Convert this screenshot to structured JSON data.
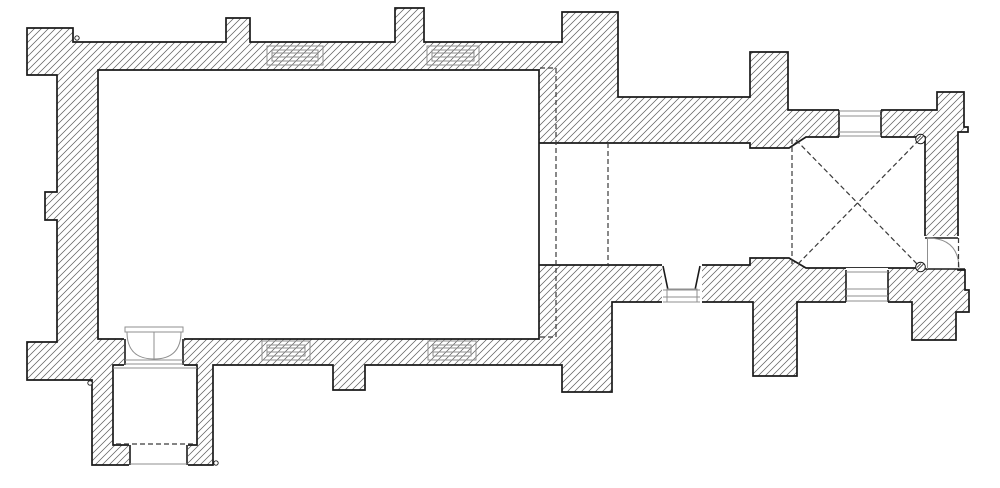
{
  "plan": {
    "name": "church-floor-plan",
    "canvas": {
      "width": 1000,
      "height": 488,
      "background": "#ffffff"
    },
    "style": {
      "outline_color": "#1a1a1a",
      "outline_width": 1.7,
      "hatch_color": "#5f5f5f",
      "hatch_width": 0.75,
      "hatch_spacing": 7,
      "detail_color": "#8f8f8f",
      "detail_width": 1,
      "black_detail_width": 1.6,
      "dash_color": "#3a3a3a",
      "dash_width": 1.2,
      "dash_pattern": "5,3"
    },
    "wall_outline": {
      "name": "exterior-wall-outline",
      "points": [
        [
          27,
          28
        ],
        [
          73,
          28
        ],
        [
          73,
          42
        ],
        [
          226,
          42
        ],
        [
          226,
          18
        ],
        [
          250,
          18
        ],
        [
          250,
          42
        ],
        [
          395,
          42
        ],
        [
          395,
          8
        ],
        [
          424,
          8
        ],
        [
          424,
          42
        ],
        [
          562,
          42
        ],
        [
          562,
          12
        ],
        [
          618,
          12
        ],
        [
          618,
          97
        ],
        [
          750,
          97
        ],
        [
          750,
          52
        ],
        [
          788,
          52
        ],
        [
          788,
          110
        ],
        [
          937,
          110
        ],
        [
          937,
          92
        ],
        [
          964,
          92
        ],
        [
          964,
          127
        ],
        [
          968,
          127
        ],
        [
          968,
          132
        ],
        [
          958,
          132
        ],
        [
          958,
          270
        ],
        [
          965,
          270
        ],
        [
          965,
          290
        ],
        [
          969,
          290
        ],
        [
          969,
          312
        ],
        [
          956,
          312
        ],
        [
          956,
          340
        ],
        [
          912,
          340
        ],
        [
          912,
          302
        ],
        [
          797,
          302
        ],
        [
          797,
          376
        ],
        [
          753,
          376
        ],
        [
          753,
          302
        ],
        [
          612,
          302
        ],
        [
          612,
          392
        ],
        [
          562,
          392
        ],
        [
          562,
          365
        ],
        [
          365,
          365
        ],
        [
          365,
          390
        ],
        [
          333,
          390
        ],
        [
          333,
          365
        ],
        [
          213,
          365
        ],
        [
          213,
          465
        ],
        [
          92,
          465
        ],
        [
          92,
          380
        ],
        [
          27,
          380
        ],
        [
          27,
          342
        ],
        [
          57,
          342
        ],
        [
          57,
          220
        ],
        [
          45,
          220
        ],
        [
          45,
          192
        ],
        [
          57,
          192
        ],
        [
          57,
          75
        ],
        [
          27,
          75
        ]
      ]
    },
    "room_openings": [
      {
        "name": "nave-interior",
        "points": [
          [
            98,
            70
          ],
          [
            539,
            70
          ],
          [
            539,
            339
          ],
          [
            98,
            339
          ]
        ]
      },
      {
        "name": "chancel-and-tower-interior",
        "points": [
          [
            539,
            143
          ],
          [
            750,
            143
          ],
          [
            750,
            148
          ],
          [
            789,
            148
          ],
          [
            806,
            137
          ],
          [
            925,
            137
          ],
          [
            925,
            268
          ],
          [
            806,
            268
          ],
          [
            789,
            258
          ],
          [
            750,
            258
          ],
          [
            750,
            265
          ],
          [
            539,
            265
          ]
        ]
      },
      {
        "name": "porch-interior",
        "points": [
          [
            113,
            365
          ],
          [
            197,
            365
          ],
          [
            197,
            445
          ],
          [
            113,
            445
          ]
        ]
      }
    ],
    "white_patches": [
      {
        "name": "tower-north-window-gap",
        "rect": [
          839,
          108,
          42,
          31
        ]
      },
      {
        "name": "tower-south-window-gap",
        "rect": [
          846,
          268,
          42,
          36
        ]
      },
      {
        "name": "chancel-south-window-gap",
        "rect": [
          662,
          264,
          40,
          40
        ]
      },
      {
        "name": "tower-east-door-gap",
        "rect": [
          923.5,
          236,
          36.5,
          32.5
        ]
      },
      {
        "name": "south-door-gap",
        "rect": [
          124,
          334,
          60,
          32
        ]
      },
      {
        "name": "porch-entrance-gap",
        "rect": [
          129,
          443,
          59,
          24
        ]
      }
    ],
    "black_lines": [
      {
        "name": "tower-north-window-left-jamb",
        "p": [
          839,
          110,
          839,
          137
        ]
      },
      {
        "name": "tower-north-window-right-jamb",
        "p": [
          881,
          110,
          881,
          137
        ]
      },
      {
        "name": "tower-south-window-left-jamb",
        "p": [
          846,
          270,
          846,
          302
        ]
      },
      {
        "name": "tower-south-window-right-jamb",
        "p": [
          888,
          270,
          888,
          302
        ]
      },
      {
        "name": "chancel-south-window-left-reveal",
        "p": [
          663,
          266,
          668,
          290
        ]
      },
      {
        "name": "chancel-south-window-right-reveal",
        "p": [
          700,
          266,
          695,
          290
        ]
      },
      {
        "name": "tower-east-door-top-jamb",
        "p": [
          925,
          238,
          958,
          238
        ]
      },
      {
        "name": "tower-east-door-bottom-jamb",
        "p": [
          925,
          269,
          965,
          269
        ]
      },
      {
        "name": "south-door-left-jamb",
        "p": [
          125,
          339,
          125,
          365
        ]
      },
      {
        "name": "south-door-right-jamb",
        "p": [
          183,
          339,
          183,
          365
        ]
      },
      {
        "name": "porch-entrance-left-jamb",
        "p": [
          130,
          445,
          130,
          465
        ]
      },
      {
        "name": "porch-entrance-right-jamb",
        "p": [
          187,
          445,
          187,
          465
        ]
      }
    ],
    "grey_rects": [
      {
        "name": "nave-north-window-1-frame",
        "rect": [
          267,
          46,
          56,
          19
        ]
      },
      {
        "name": "nave-north-window-1-slot",
        "rect": [
          272,
          50,
          46,
          11
        ]
      },
      {
        "name": "nave-north-window-2-frame",
        "rect": [
          427,
          46,
          52,
          19
        ]
      },
      {
        "name": "nave-north-window-2-slot",
        "rect": [
          432,
          50,
          42,
          11
        ]
      },
      {
        "name": "nave-south-window-1-frame",
        "rect": [
          262,
          341,
          48,
          19
        ]
      },
      {
        "name": "nave-south-window-1-slot",
        "rect": [
          267,
          345,
          38,
          11
        ]
      },
      {
        "name": "nave-south-window-2-frame",
        "rect": [
          428,
          341,
          48,
          19
        ]
      },
      {
        "name": "nave-south-window-2-slot",
        "rect": [
          433,
          345,
          38,
          11
        ]
      },
      {
        "name": "chancel-south-window-slot",
        "rect": [
          667,
          289,
          30,
          13
        ]
      },
      {
        "name": "south-door-head-band",
        "rect": [
          125,
          327,
          58,
          5
        ]
      }
    ],
    "grey_lines": [
      {
        "name": "tower-north-window-line-1",
        "p": [
          839,
          111,
          881,
          111
        ]
      },
      {
        "name": "tower-north-window-line-2",
        "p": [
          839,
          116,
          881,
          116
        ]
      },
      {
        "name": "tower-north-window-line-3",
        "p": [
          839,
          132,
          881,
          132
        ]
      },
      {
        "name": "tower-north-window-line-4",
        "p": [
          839,
          136,
          881,
          136
        ]
      },
      {
        "name": "tower-south-window-line-1",
        "p": [
          846,
          272,
          888,
          272
        ]
      },
      {
        "name": "tower-south-window-line-2",
        "p": [
          846,
          289,
          888,
          289
        ]
      },
      {
        "name": "tower-south-window-line-3",
        "p": [
          846,
          296,
          888,
          296
        ]
      },
      {
        "name": "tower-south-window-line-4",
        "p": [
          846,
          301,
          888,
          301
        ]
      },
      {
        "name": "chancel-south-window-line-1",
        "p": [
          663,
          290,
          700,
          290
        ]
      },
      {
        "name": "chancel-south-window-line-2",
        "p": [
          663,
          297,
          700,
          297
        ]
      },
      {
        "name": "chancel-south-window-line-3",
        "p": [
          663,
          302,
          700,
          302
        ]
      },
      {
        "name": "nave-north-window-1-glazing-a",
        "p": [
          272,
          53,
          318,
          53
        ]
      },
      {
        "name": "nave-north-window-1-glazing-b",
        "p": [
          272,
          57,
          318,
          57
        ]
      },
      {
        "name": "nave-north-window-2-glazing-a",
        "p": [
          432,
          53,
          474,
          53
        ]
      },
      {
        "name": "nave-north-window-2-glazing-b",
        "p": [
          432,
          57,
          474,
          57
        ]
      },
      {
        "name": "nave-south-window-1-glazing-a",
        "p": [
          267,
          348,
          305,
          348
        ]
      },
      {
        "name": "nave-south-window-1-glazing-b",
        "p": [
          267,
          352,
          305,
          352
        ]
      },
      {
        "name": "nave-south-window-2-glazing-a",
        "p": [
          433,
          348,
          471,
          348
        ]
      },
      {
        "name": "nave-south-window-2-glazing-b",
        "p": [
          433,
          352,
          471,
          352
        ]
      },
      {
        "name": "south-door-sill-line-1",
        "p": [
          125,
          360,
          183,
          360
        ]
      },
      {
        "name": "south-door-sill-line-2",
        "p": [
          125,
          364,
          183,
          364
        ]
      },
      {
        "name": "porch-north-face-line",
        "p": [
          113,
          368,
          197,
          368
        ]
      },
      {
        "name": "south-door-leaf-meeting",
        "p": [
          154,
          332,
          154,
          359
        ]
      },
      {
        "name": "porch-entrance-threshold",
        "p": [
          130,
          464,
          187,
          464
        ]
      },
      {
        "name": "tower-east-door-leaf",
        "p": [
          927.5,
          238,
          927.5,
          269
        ]
      }
    ],
    "arcs": [
      {
        "name": "south-door-left-swing-arc",
        "start": [
          127,
          332
        ],
        "ctrl": [
          127,
          359
        ],
        "end": [
          154,
          359
        ]
      },
      {
        "name": "south-door-right-swing-arc",
        "start": [
          181,
          332
        ],
        "ctrl": [
          181,
          359
        ],
        "end": [
          154,
          359
        ]
      },
      {
        "name": "tower-east-door-swing-arc",
        "start": [
          927,
          238
        ],
        "ctrl": [
          959,
          238
        ],
        "end": [
          959,
          269
        ]
      }
    ],
    "dashed_paths": [
      {
        "name": "chancel-arch-respond-outline",
        "points": [
          [
            540,
            68
          ],
          [
            556,
            68
          ],
          [
            556,
            337
          ],
          [
            540,
            337
          ]
        ]
      },
      {
        "name": "chancel-step-line",
        "points": [
          [
            608,
            143
          ],
          [
            608,
            265
          ]
        ]
      },
      {
        "name": "tower-arch-line",
        "points": [
          [
            792,
            139
          ],
          [
            792,
            267
          ]
        ]
      },
      {
        "name": "tower-vault-rib-nw-se",
        "points": [
          [
            796,
            140
          ],
          [
            919,
            266
          ]
        ]
      },
      {
        "name": "tower-vault-rib-ne-sw",
        "points": [
          [
            919,
            140
          ],
          [
            796,
            266
          ]
        ]
      },
      {
        "name": "porch-floor-edge",
        "points": [
          [
            116,
            444
          ],
          [
            194,
            444
          ]
        ]
      },
      {
        "name": "tower-east-door-open-leaf",
        "points": [
          [
            958.5,
            238
          ],
          [
            958.5,
            269
          ]
        ]
      }
    ],
    "shaft_circles": [
      {
        "name": "tower-ne-shaft",
        "cx": 920.5,
        "cy": 139,
        "r": 4.8
      },
      {
        "name": "tower-se-shaft",
        "cx": 920.5,
        "cy": 267,
        "r": 4.8
      }
    ],
    "marker_circles": [
      {
        "name": "nw-corner-marker",
        "cx": 77,
        "cy": 38,
        "r": 2.2
      },
      {
        "name": "sw-corner-marker",
        "cx": 90,
        "cy": 383,
        "r": 2.2
      },
      {
        "name": "porch-corner-marker",
        "cx": 216,
        "cy": 463,
        "r": 2.2
      }
    ]
  }
}
